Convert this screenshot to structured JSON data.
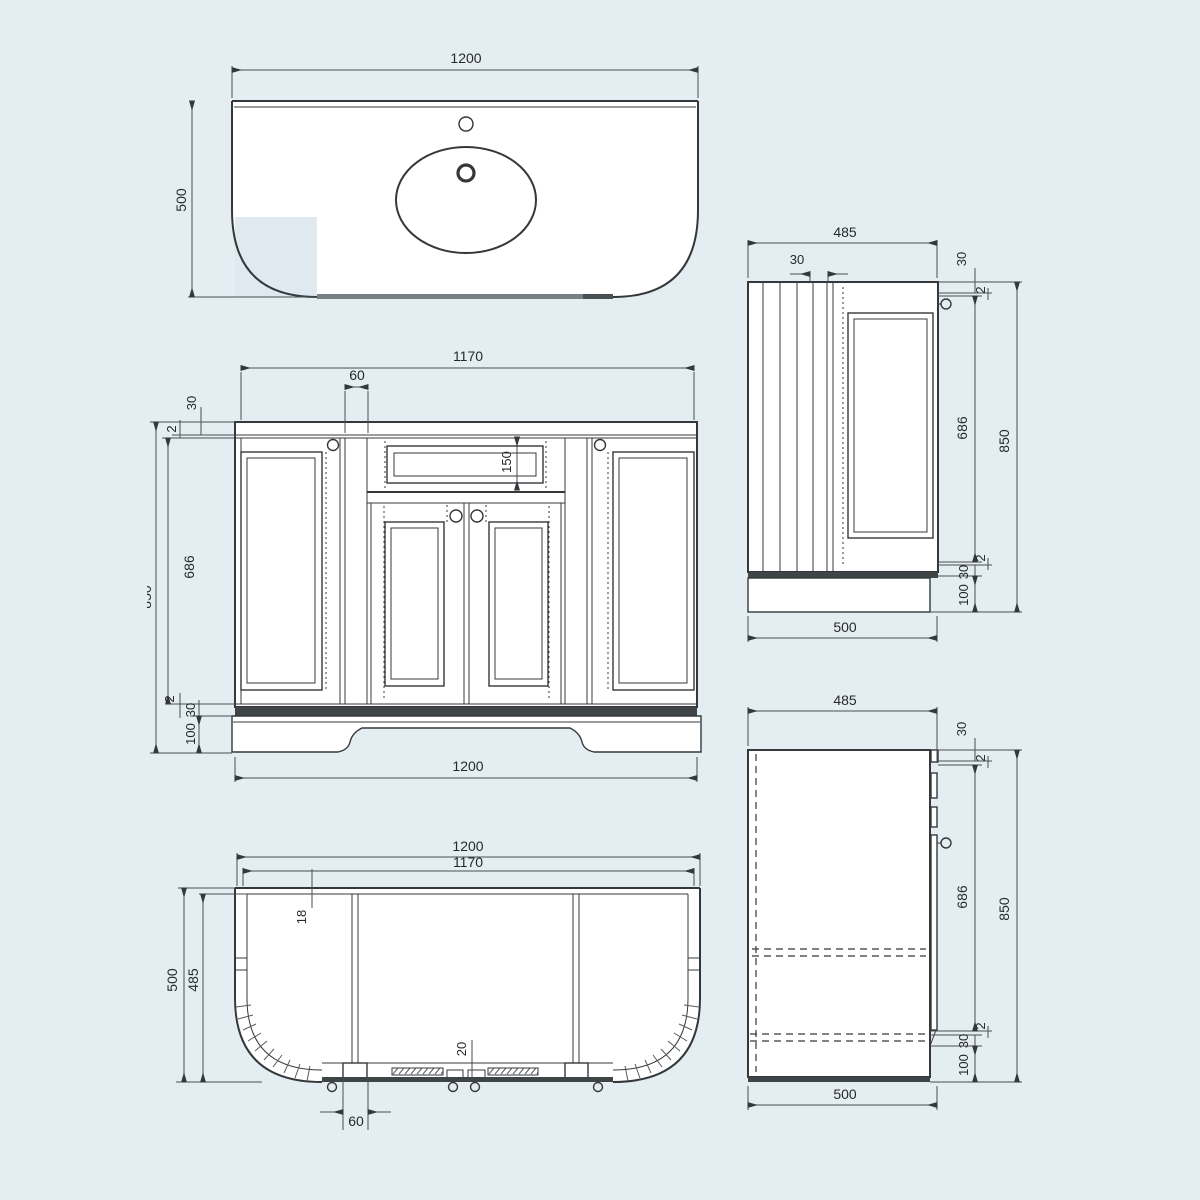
{
  "title": "vanity-unit-technical-drawing",
  "colors": {
    "background": "#e4edf2",
    "line": "#34383b",
    "dark_band": "#3f4447",
    "gray_edge": "#788085"
  },
  "views": {
    "plan_top": {
      "name": "countertop plan view",
      "dims": {
        "width": "1200",
        "depth": "500"
      }
    },
    "front": {
      "name": "front elevation",
      "dims": {
        "opening_width": "1170",
        "stile_width": "60",
        "top_rail": "30",
        "top_gap": "2",
        "door_height": "686",
        "overall_height": "850",
        "bottom_gap": "2",
        "bottom_rail": "30",
        "plinth_height": "100",
        "drawer_height": "150",
        "overall_width": "1200"
      }
    },
    "side_upper": {
      "name": "side elevation (panel side)",
      "dims": {
        "depth": "485",
        "back_offset": "30",
        "top_rail": "30",
        "top_gap": "2",
        "door_height": "686",
        "overall_height": "850",
        "bottom_gap": "2",
        "bottom_rail": "30",
        "plinth_height": "100",
        "base_depth": "500"
      }
    },
    "plan_bottom": {
      "name": "underside plan view",
      "dims": {
        "overall_width": "1200",
        "opening_width": "1170",
        "panel_thickness": "18",
        "depth": "500",
        "carcass_depth": "485",
        "front_edge": "20",
        "divider_width": "60"
      }
    },
    "side_lower": {
      "name": "side section view",
      "dims": {
        "depth": "485",
        "top_rail": "30",
        "top_gap": "2",
        "door_height": "686",
        "overall_height": "850",
        "bottom_gap": "2",
        "bottom_rail": "30",
        "plinth_height": "100",
        "base_depth": "500"
      }
    }
  }
}
